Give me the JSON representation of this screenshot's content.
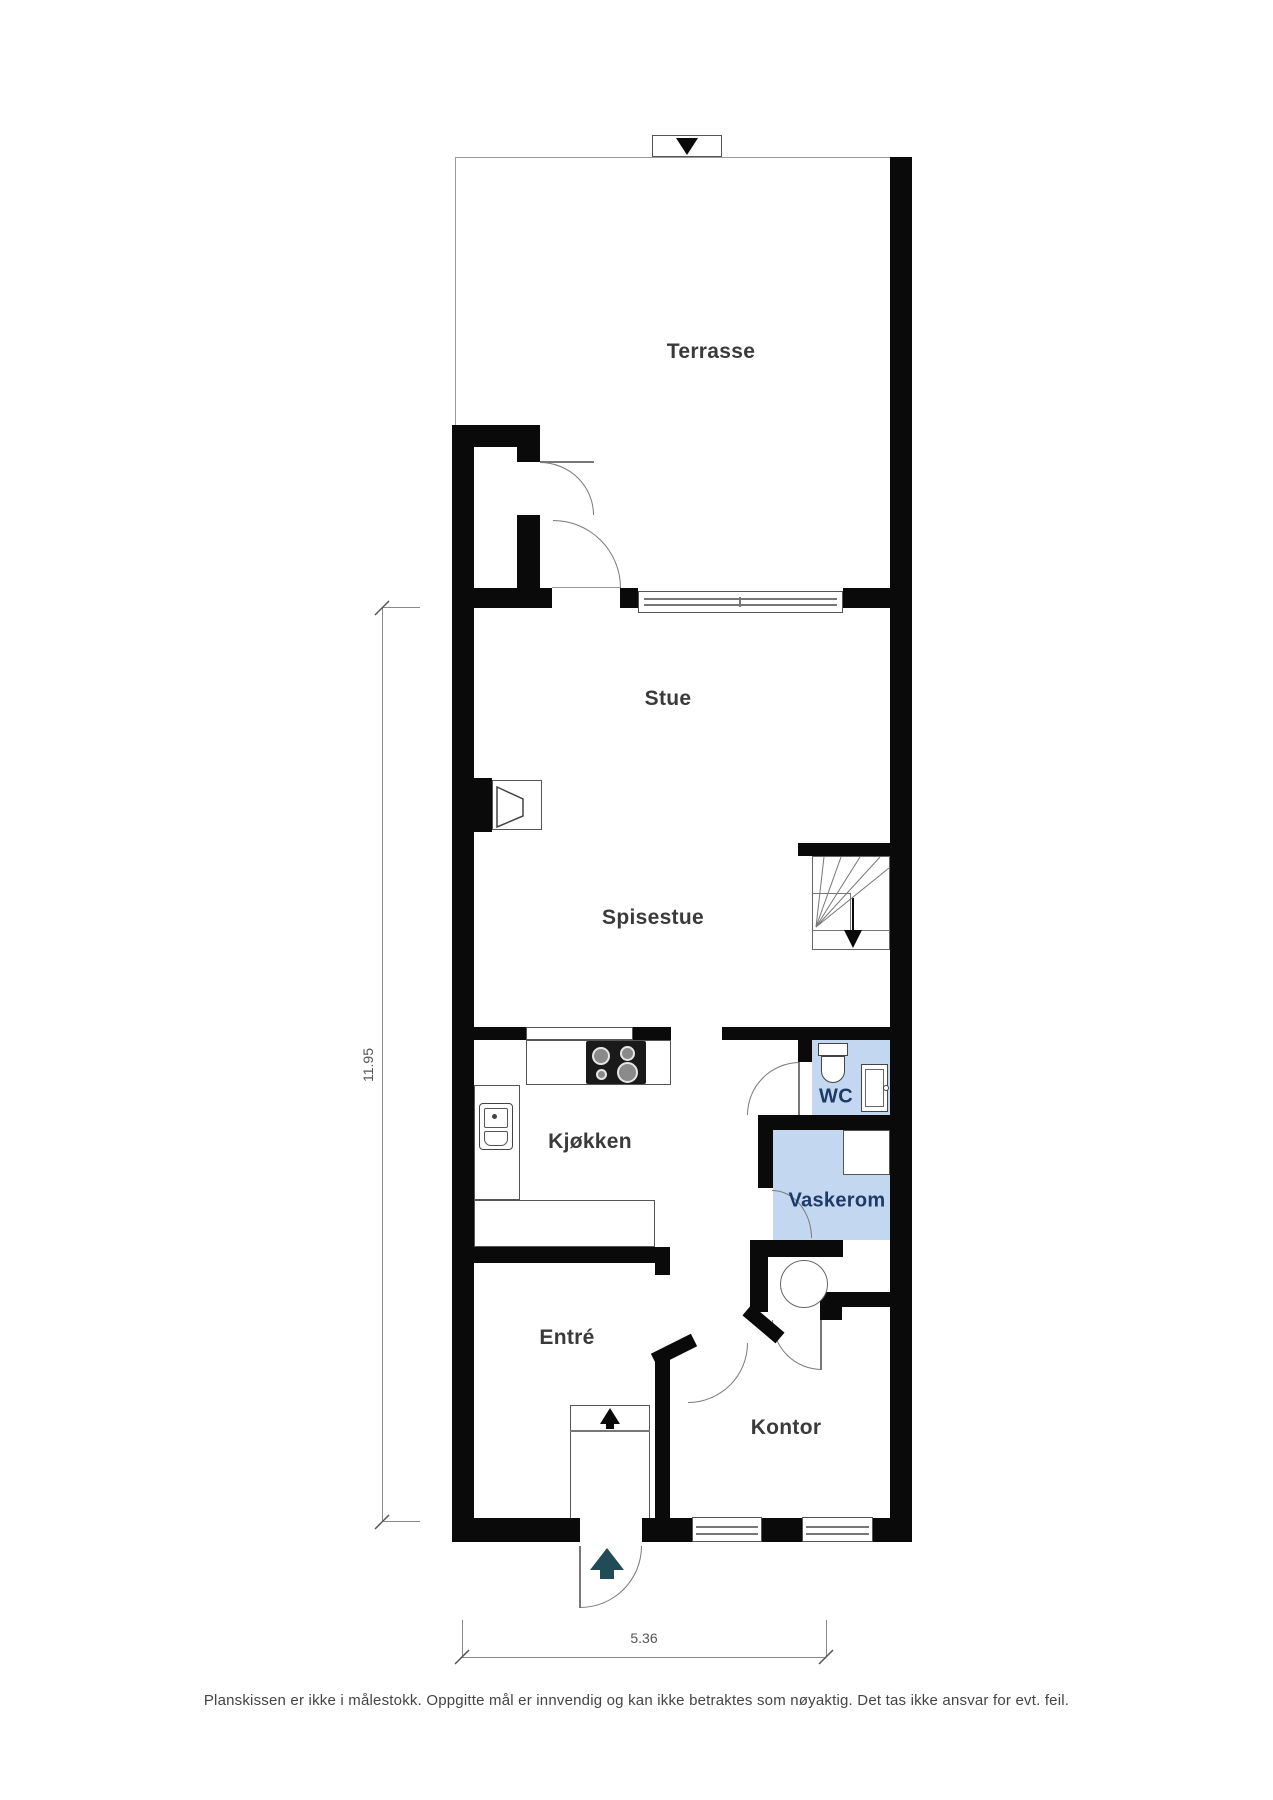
{
  "plan": {
    "rooms": {
      "terrasse": "Terrasse",
      "stue": "Stue",
      "spisestue": "Spisestue",
      "kjokken": "Kjøkken",
      "wc": "WC",
      "vaskerom": "Vaskerom",
      "entre": "Entré",
      "kontor": "Kontor"
    },
    "dimensions": {
      "height": "11.95",
      "width": "5.36"
    },
    "disclaimer": "Planskissen er ikke i målestokk. Oppgitte mål er innvendig og kan ikke betraktes som nøyaktig. Det tas ikke ansvar for evt. feil.",
    "icons": {
      "north_marker": "triangle-down",
      "entry_direction": "arrow-up",
      "main_entrance": "arrow-up-teal",
      "stairs_direction": "triangle-down",
      "stove": "four-burner-cooktop",
      "kitchen_sink": "double-basin-sink",
      "toilet": "toilet",
      "washbasin": "washbasin",
      "water_heater": "circle-tank",
      "fireplace": "fireplace-funnel"
    },
    "colors": {
      "wall": "#0a0a0a",
      "line": "#777777",
      "wet_fill": "#c3d8f0",
      "wet_label": "#1e3a66",
      "arrow_teal": "#224b58",
      "label": "#3a3a3a",
      "dim": "#555555",
      "disclaimer": "#444444"
    }
  }
}
